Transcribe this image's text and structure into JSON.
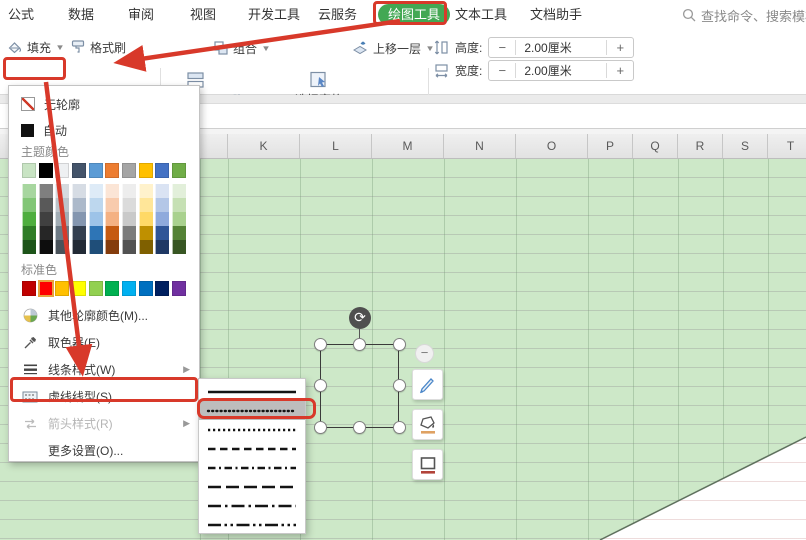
{
  "window": {
    "tabs": [
      {
        "id": "formulas",
        "label": "公式"
      },
      {
        "id": "data",
        "label": "数据"
      },
      {
        "id": "review",
        "label": "审阅"
      },
      {
        "id": "view",
        "label": "视图"
      },
      {
        "id": "dev-tools",
        "label": "开发工具"
      },
      {
        "id": "cloud-service",
        "label": "云服务"
      },
      {
        "id": "drawing-tools",
        "label": "绘图工具",
        "active": true
      },
      {
        "id": "text-tools",
        "label": "文本工具"
      },
      {
        "id": "doc-assistant",
        "label": "文档助手"
      }
    ],
    "search": {
      "icon": "magnifier",
      "placeholder": "查找命令、搜索模板"
    }
  },
  "toolbar": {
    "fill": "填充",
    "format_painter": "格式刷",
    "outline": "轮廓",
    "shape_effects": "形状效果",
    "align": "对齐",
    "group": "组合",
    "rotate": "旋转",
    "selection_pane": "选择窗格",
    "bring_forward": "上移一层",
    "send_backward": "下移一层",
    "height": {
      "label": "高度:",
      "value": "2.00厘米",
      "minus": "−",
      "plus": "+"
    },
    "width": {
      "label": "宽度:",
      "value": "2.00厘米",
      "minus": "−",
      "plus": "+"
    }
  },
  "outline_menu": {
    "no_outline": "无轮廓",
    "automatic": "自动",
    "theme_colors_label": "主题颜色",
    "standard_colors_label": "标准色",
    "theme_colors": {
      "base": [
        "#c9e4c4",
        "#000000",
        "#eef0f2",
        "#44546a",
        "#5b9bd5",
        "#ed7d31",
        "#a5a5a5",
        "#ffc000",
        "#4472c4",
        "#70ad47"
      ],
      "tints": [
        [
          "#a7d69f",
          "#7f7f7f",
          "#d5dade",
          "#d6dce4",
          "#deebf7",
          "#fbe5d6",
          "#ededed",
          "#fff2cc",
          "#dae3f3",
          "#e2efda"
        ],
        [
          "#82c676",
          "#595959",
          "#bcc4ca",
          "#acb9ca",
          "#bdd7ee",
          "#f8cbad",
          "#dbdbdb",
          "#ffe699",
          "#b4c7e7",
          "#c6e0b4"
        ],
        [
          "#4fae3f",
          "#404040",
          "#a2adb5",
          "#8496b0",
          "#9dc3e8",
          "#f4b183",
          "#c9c9c9",
          "#ffd966",
          "#8faadc",
          "#a9d18e"
        ],
        [
          "#2f7d27",
          "#262626",
          "#6d7a85",
          "#333f50",
          "#2e75b6",
          "#c55a11",
          "#7b7b7b",
          "#bf9000",
          "#2f5597",
          "#548235"
        ],
        [
          "#1d5419",
          "#0d0d0d",
          "#49525a",
          "#222a35",
          "#1f4e79",
          "#843c0c",
          "#525252",
          "#7f6000",
          "#1f3864",
          "#385623"
        ]
      ]
    },
    "standard_colors": [
      "#c00000",
      "#fe0000",
      "#ffc000",
      "#ffff00",
      "#92d050",
      "#00b050",
      "#00b0f0",
      "#0070c0",
      "#002060",
      "#7030a0"
    ],
    "standard_selected_index": 1,
    "items": [
      {
        "id": "more-outline-colors",
        "label": "其他轮廓颜色(M)...",
        "icon": "color-wheel",
        "disabled": false,
        "submenu_arrow": false
      },
      {
        "id": "eyedropper",
        "label": "取色器(E)",
        "icon": "eyedropper",
        "disabled": false,
        "submenu_arrow": false
      },
      {
        "id": "line-style",
        "label": "线条样式(W)",
        "icon": "line-weights",
        "disabled": false,
        "submenu_arrow": true
      },
      {
        "id": "dash-style",
        "label": "虚线线型(S)",
        "icon": "dashed-rect",
        "disabled": false,
        "submenu_arrow": false,
        "annotated": true
      },
      {
        "id": "arrow-style",
        "label": "箭头样式(R)",
        "icon": "arrows",
        "disabled": true,
        "submenu_arrow": true
      },
      {
        "id": "more-settings",
        "label": "更多设置(O)...",
        "icon": "none",
        "disabled": false,
        "submenu_arrow": false
      }
    ]
  },
  "dash_submenu": {
    "selected_index": 1,
    "styles": [
      {
        "name": "solid",
        "dash": ""
      },
      {
        "name": "round-dot",
        "dash": "1 3.2"
      },
      {
        "name": "square-dot",
        "dash": "2.2 2.8"
      },
      {
        "name": "dash",
        "dash": "7.5 4.5"
      },
      {
        "name": "dash-dot",
        "dash": "7.5 3.5 2 3.5"
      },
      {
        "name": "long-dash",
        "dash": "13 5"
      },
      {
        "name": "long-dash-dot",
        "dash": "13 4 2.5 4"
      },
      {
        "name": "long-dash-dot-dot",
        "dash": "13 3.5 2.5 3.5 2.5 3.5"
      }
    ]
  },
  "sheet": {
    "columns": [
      "K",
      "L",
      "M",
      "N",
      "O",
      "P",
      "Q",
      "R",
      "S",
      "T"
    ]
  },
  "selection": {
    "shape": "square",
    "handles": 8,
    "rotate_handle": true
  },
  "colors": {
    "annotation_red": "#d8392a",
    "active_tab_green": "#43a854",
    "sheet_green": "#cde8c8"
  }
}
